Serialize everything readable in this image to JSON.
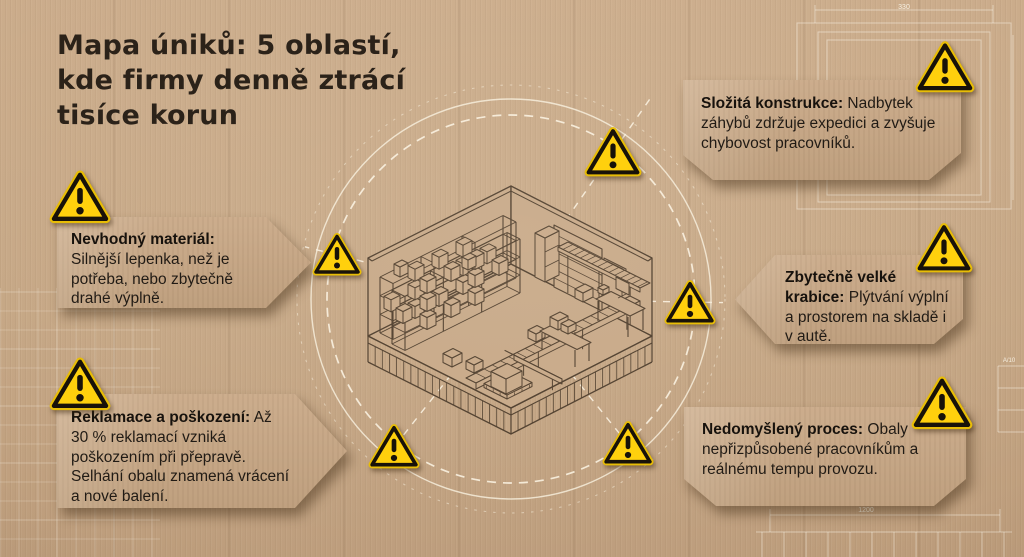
{
  "header": {
    "title": "Mapa úniků: 5 oblastí,\nkde firmy denně ztrácí\ntisíce korun"
  },
  "callouts": [
    {
      "id": "slozita-konstrukce",
      "lead": "Složitá konstrukce:",
      "text": " Nadbytek záhybů zdržuje expedici a zvyšuje chybovost pracovníků."
    },
    {
      "id": "nevhodny-material",
      "lead": "Nevhodný materiál:",
      "text": " Silnější lepenka, než je potřeba, nebo zbytečně drahé výplně."
    },
    {
      "id": "zbytecne-velke-krabice",
      "lead": "Zbytečně velké krabice:",
      "text": " Plýtvání výplní a prostorem na skladě i v autě."
    },
    {
      "id": "reklamace-a-poskozeni",
      "lead": "Reklamace a poškození:",
      "text": " Až 30 % reklamací vzniká poškozením při přepravě. Selhání obalu znamená vrácení a nové balení."
    },
    {
      "id": "nedomysleny-proces",
      "lead": "Nedomyšlený proces:",
      "text": " Obaly nepřizpůsobené pracovníkům a reálnému tempu provozu."
    }
  ],
  "blueprint": {
    "dim_top": "330",
    "dim_bottom": "1200",
    "sheet_label": "A/10"
  },
  "icons": {
    "warning": "warning-triangle-icon"
  },
  "colors": {
    "background": "#c5a685",
    "callout_fill": "#c7a987",
    "ink": "#4b3a29",
    "warning_yellow": "#ffcc0a",
    "text": "#211b15",
    "blueprint_line": "#f6edd9"
  }
}
